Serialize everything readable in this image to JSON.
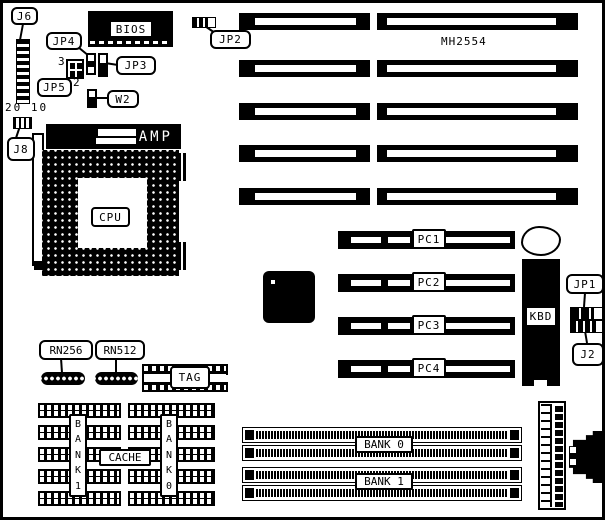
{
  "board": {
    "part_number": "MH2554",
    "connectors": {
      "j6": "J6",
      "j8": "J8",
      "jp1": "JP1",
      "jp2": "JP2",
      "jp3": "JP3",
      "jp4": "JP4",
      "jp5": "JP5",
      "w2": "W2",
      "j2": "J2",
      "kbd": "KBD"
    },
    "chips": {
      "bios": "BIOS",
      "cpu": "CPU",
      "amp": "AMP",
      "tag": "TAG",
      "cache": "CACHE",
      "rn256": "RN256",
      "rn512": "RN512"
    },
    "pin_annotations": {
      "j6_pins": "20 10",
      "pin3": "3",
      "pin2": "2"
    },
    "pci_slots": [
      {
        "label": "PC1"
      },
      {
        "label": "PC2"
      },
      {
        "label": "PC3"
      },
      {
        "label": "PC4"
      }
    ],
    "cache_banks": {
      "bank1": "B\nA\nN\nK\n1",
      "bank0": "B\nA\nN\nK\n0"
    },
    "simm_banks": [
      {
        "label": "BANK 0"
      },
      {
        "label": "BANK 1"
      }
    ]
  }
}
